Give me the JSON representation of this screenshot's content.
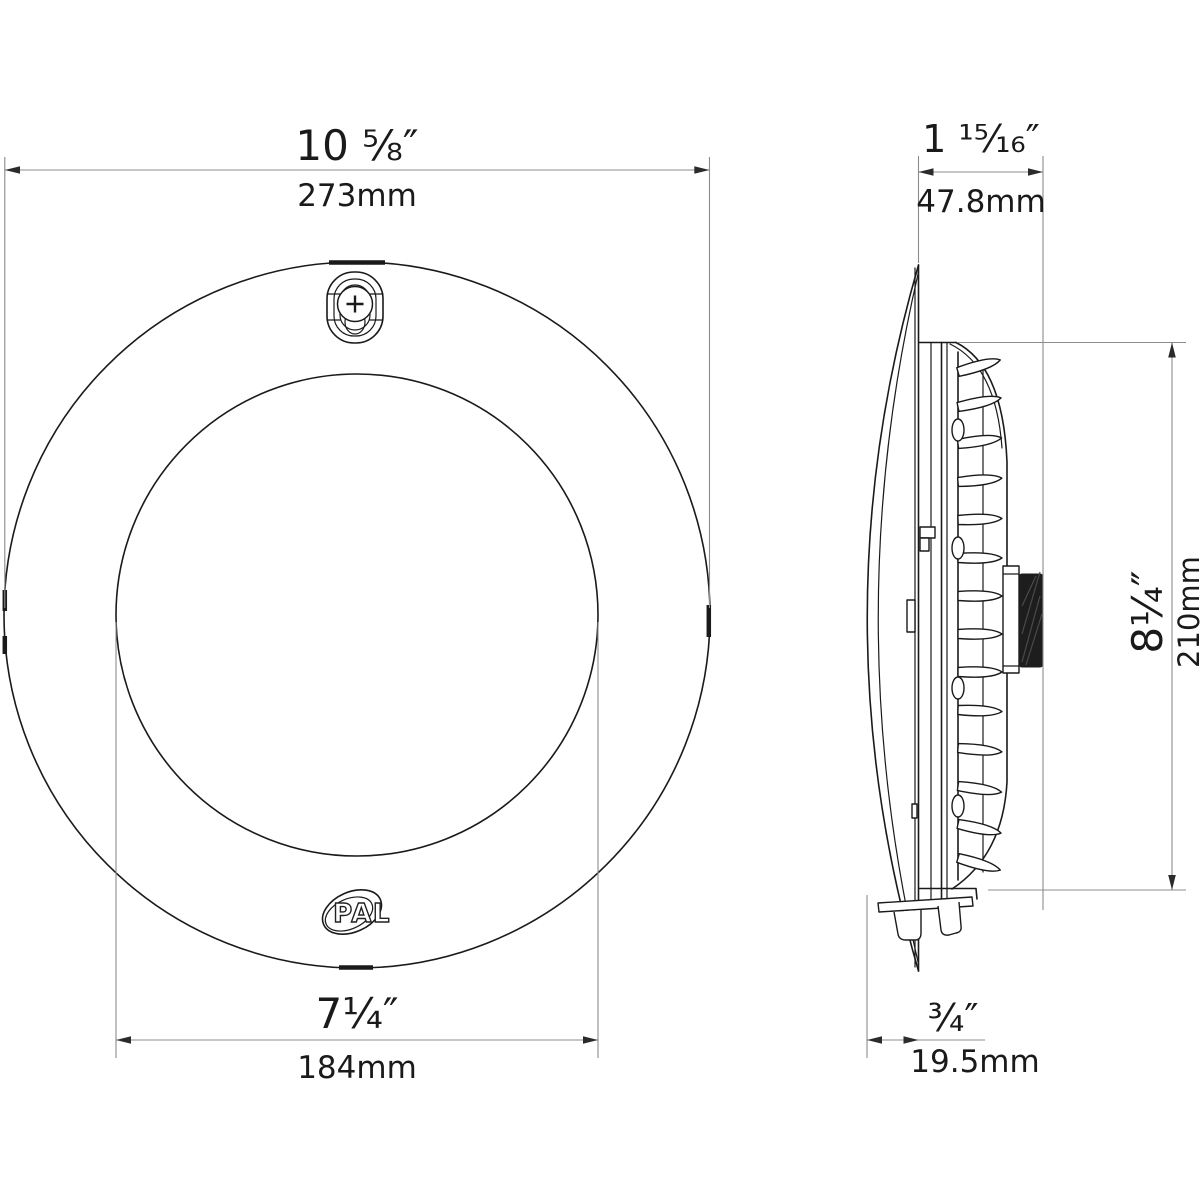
{
  "dims": {
    "outer_width": {
      "inches": "10 ⅝″",
      "mm": "273mm"
    },
    "depth": {
      "inches": "1 ¹⁵⁄₁₆″",
      "mm": "47.8mm"
    },
    "lens_width": {
      "inches": "7¼″",
      "mm": "184mm"
    },
    "body_height": {
      "inches": "8¼″",
      "mm": "210mm"
    },
    "lens_protrusion": {
      "inches": "¾″",
      "mm": "19.5mm"
    }
  },
  "logo": {
    "text": "PAL"
  },
  "colors": {
    "part_line": "#1a1a1a",
    "dimension_line": "#8c8c8c",
    "arrowhead": "#2b2b2b",
    "label_text": "#1a1a1a",
    "background": "#ffffff"
  }
}
